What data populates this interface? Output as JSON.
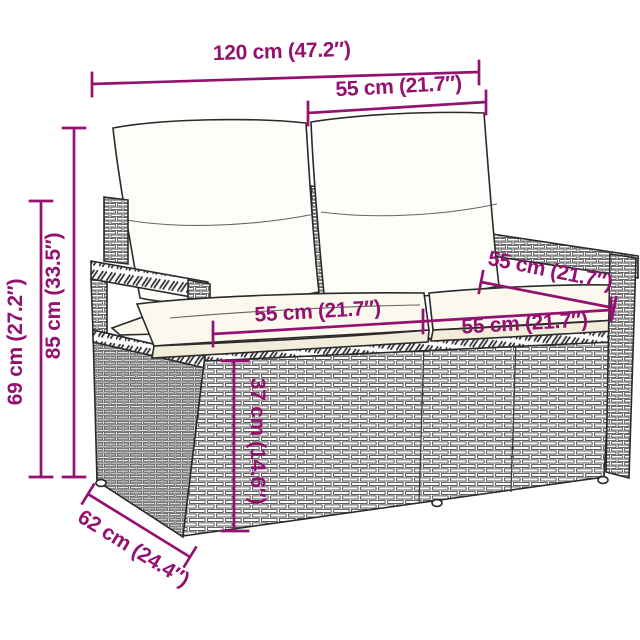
{
  "figure": {
    "subject": "poly-rattan-2-seater-garden-sofa-dimension-diagram",
    "accent_color": "#941170",
    "line_color": "#2a2a2a",
    "background": "#ffffff"
  },
  "dimensions": {
    "overall_width": "120 cm (47.2″)",
    "back_cushion_width": "55 cm (21.7″)",
    "total_height": "85 cm (33.5″)",
    "armrest_height": "69 cm (27.2″)",
    "seat_width_left": "55 cm (21.7″)",
    "seat_width_right": "55 cm (21.7″)",
    "seat_depth": "55 cm (21.7″)",
    "seat_height": "37 cm (14.6″)",
    "overall_depth": "62 cm (24.4″)"
  }
}
